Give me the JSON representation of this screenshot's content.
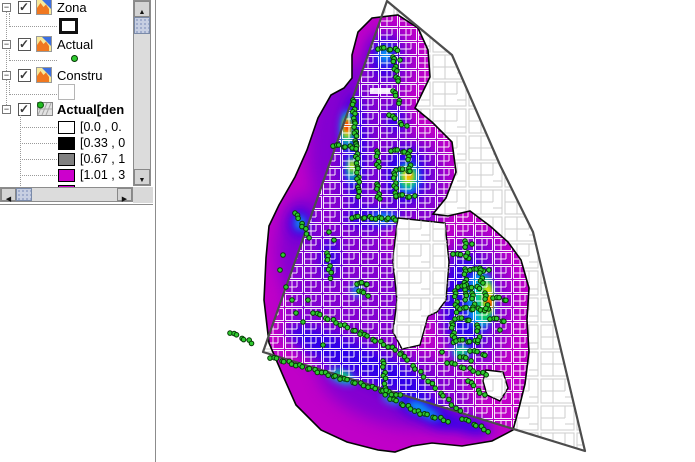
{
  "layer_tree": {
    "items": [
      {
        "label": "Zona",
        "slug": "zona",
        "checked": true,
        "bold": false,
        "icon": "vector-polygon-icon",
        "symbol": {
          "kind": "rect",
          "fill": "#ffffff",
          "border": "#111111",
          "border_px": 3
        }
      },
      {
        "label": "Actual",
        "slug": "actual",
        "checked": true,
        "bold": false,
        "icon": "vector-polygon-icon",
        "symbol": {
          "kind": "dot",
          "fill": "#2fcb2f",
          "border": "#063806"
        }
      },
      {
        "label": "Constru",
        "slug": "constru",
        "checked": true,
        "bold": false,
        "icon": "vector-polygon-icon",
        "symbol": {
          "kind": "rect",
          "fill": "#ffffff",
          "border": "#b5b5b5",
          "border_px": 1
        }
      },
      {
        "label": "Actual[den",
        "slug": "actual-den",
        "checked": true,
        "bold": true,
        "icon": "raster-grid-icon",
        "classes": [
          {
            "color": "#ffffff",
            "label": "[0.0 , 0."
          },
          {
            "color": "#000000",
            "label": "[0.33 , 0"
          },
          {
            "color": "#808080",
            "label": "[0.67 , 1"
          },
          {
            "color": "#cc00cc",
            "label": "[1.01 , 3"
          },
          {
            "color": "#cc00cc",
            "label": ""
          }
        ]
      }
    ]
  },
  "scrollbar": {
    "up": "▲",
    "down": "▼",
    "left": "◀",
    "right": "▶"
  },
  "map": {
    "boundary_color": "#4c4c4c",
    "boundary_path": "M387,1 L452,55 L500,165 L533,232 L585,451 L263,352 Z",
    "parcel_gray": "#cdcdcd",
    "parcel_white": "rgba(255,255,255,0.92)",
    "blob_fill": "#c000c8",
    "blob_outline": "#050505",
    "blob_path": "M372,18 L398,15 L418,28 L428,50 L430,77 L415,108 L432,122 L452,142 L456,172 L446,198 L433,214 L448,216 L470,211 L490,226 L508,242 L521,260 L529,288 L527,320 L529,352 L525,384 L519,408 L513,430 L492,441 L462,446 L432,443 L412,446 L395,452 L378,450 L347,442 L321,430 L296,405 L284,378 L269,343 L264,300 L266,258 L269,226 L279,205 L295,177 L307,150 L318,118 L331,95 L344,88 L352,78 L352,55 L358,32 Z",
    "holes": [
      "M398,218 L445,223 L449,262 L446,300 L437,312 L428,316 L420,345 L402,349 L393,332 L397,300 L393,262 L395,240 Z",
      "M486,370 L503,372 L508,388 L500,401 L487,395 L483,381 Z"
    ],
    "heat_bands": [
      {
        "name": "purple",
        "color": "#8000d2",
        "blur": 8,
        "ellipses": [
          [
            360,
            150,
            52,
            88,
            0
          ],
          [
            348,
            300,
            62,
            78,
            0
          ],
          [
            395,
            385,
            80,
            40,
            15
          ],
          [
            473,
            302,
            38,
            70,
            0
          ],
          [
            388,
            62,
            26,
            34,
            0
          ],
          [
            420,
            185,
            28,
            48,
            0
          ],
          [
            303,
            250,
            26,
            55,
            0
          ],
          [
            390,
            120,
            18,
            26,
            0
          ]
        ]
      },
      {
        "name": "blue",
        "color": "#2a06ea",
        "blur": 6,
        "ellipses": [
          [
            355,
            150,
            12,
            56,
            0
          ],
          [
            405,
            175,
            22,
            30,
            0
          ],
          [
            385,
            58,
            14,
            21,
            0
          ],
          [
            373,
            218,
            30,
            11,
            0
          ],
          [
            358,
            360,
            78,
            16,
            23
          ],
          [
            467,
            303,
            24,
            50,
            0
          ],
          [
            300,
            223,
            10,
            14,
            0
          ],
          [
            420,
            406,
            26,
            12,
            22
          ],
          [
            395,
            120,
            10,
            13,
            0
          ],
          [
            330,
            258,
            9,
            20,
            0
          ],
          [
            385,
            378,
            8,
            14,
            0
          ],
          [
            442,
            420,
            20,
            9,
            15
          ],
          [
            470,
            426,
            22,
            8,
            12
          ]
        ]
      },
      {
        "name": "cyan",
        "color": "#00b6f6",
        "blur": 4,
        "ellipses": [
          [
            347,
            130,
            6,
            20,
            0
          ],
          [
            352,
            170,
            5,
            13,
            0
          ],
          [
            408,
            178,
            11,
            15,
            0
          ],
          [
            385,
            55,
            6,
            9,
            0
          ],
          [
            300,
            223,
            5,
            7,
            0
          ],
          [
            342,
            377,
            14,
            6,
            20
          ],
          [
            418,
            407,
            11,
            5,
            20
          ],
          [
            480,
            300,
            13,
            29,
            0
          ],
          [
            461,
            352,
            9,
            6,
            0
          ],
          [
            384,
            218,
            13,
            5,
            0
          ],
          [
            392,
            399,
            10,
            4,
            20
          ],
          [
            357,
            290,
            5,
            7,
            0
          ],
          [
            430,
            414,
            10,
            4,
            20
          ]
        ]
      },
      {
        "name": "green",
        "color": "#11d24b",
        "blur": 3,
        "ellipses": [
          [
            347,
            129,
            4.5,
            14,
            0
          ],
          [
            408,
            177,
            8,
            11,
            0
          ],
          [
            485,
            300,
            8,
            23,
            0
          ],
          [
            461,
            351,
            6,
            4,
            0
          ],
          [
            352,
            168,
            3.5,
            9,
            0
          ],
          [
            342,
            376,
            8,
            4,
            20
          ]
        ]
      },
      {
        "name": "yellow",
        "color": "#ffe100",
        "blur": 2.5,
        "ellipses": [
          [
            347,
            128,
            3.2,
            10,
            0
          ],
          [
            408,
            176,
            5.5,
            7,
            0
          ],
          [
            488,
            298,
            4.5,
            15,
            0
          ],
          [
            352,
            166,
            2.5,
            6,
            0
          ]
        ]
      },
      {
        "name": "orange",
        "color": "#ff8a00",
        "blur": 2,
        "ellipses": [
          [
            347,
            127,
            2.6,
            7,
            0
          ],
          [
            489,
            303,
            3,
            8,
            0
          ],
          [
            409,
            176,
            2.5,
            3.5,
            0
          ]
        ]
      },
      {
        "name": "red",
        "color": "#ff2000",
        "blur": 1.5,
        "ellipses": [
          [
            347,
            126,
            2.2,
            5.5,
            0
          ],
          [
            489,
            304,
            1.8,
            4,
            0
          ]
        ]
      }
    ],
    "street_label_rect": [
      370,
      88,
      25,
      6
    ],
    "dot_style": {
      "r": 2.3,
      "fill": "#2fcb2f",
      "stroke": "#063806"
    },
    "dot_segments": [
      [
        378,
        48,
        398,
        50,
        7
      ],
      [
        393,
        56,
        396,
        72,
        6
      ],
      [
        396,
        76,
        399,
        82,
        3
      ],
      [
        393,
        90,
        400,
        103,
        5
      ],
      [
        389,
        114,
        406,
        127,
        6
      ],
      [
        353,
        99,
        356,
        143,
        15
      ],
      [
        356,
        143,
        359,
        196,
        17
      ],
      [
        333,
        145,
        356,
        148,
        8
      ],
      [
        295,
        212,
        309,
        237,
        8
      ],
      [
        377,
        150,
        378,
        168,
        6
      ],
      [
        377,
        183,
        379,
        200,
        6
      ],
      [
        391,
        150,
        409,
        152,
        6
      ],
      [
        408,
        153,
        410,
        168,
        5
      ],
      [
        396,
        169,
        411,
        171,
        5
      ],
      [
        394,
        172,
        396,
        196,
        8
      ],
      [
        396,
        195,
        414,
        197,
        6
      ],
      [
        352,
        217,
        396,
        219,
        14
      ],
      [
        357,
        283,
        368,
        284,
        5
      ],
      [
        359,
        290,
        367,
        295,
        4
      ],
      [
        327,
        252,
        331,
        278,
        7
      ],
      [
        270,
        357,
        340,
        378,
        20
      ],
      [
        340,
        378,
        400,
        396,
        16
      ],
      [
        313,
        312,
        360,
        333,
        13
      ],
      [
        360,
        333,
        400,
        352,
        11
      ],
      [
        400,
        353,
        460,
        412,
        16
      ],
      [
        462,
        418,
        488,
        431,
        8
      ],
      [
        383,
        360,
        386,
        395,
        10
      ],
      [
        390,
        398,
        418,
        412,
        9
      ],
      [
        420,
        413,
        448,
        421,
        8
      ],
      [
        447,
        362,
        487,
        375,
        10
      ],
      [
        468,
        380,
        484,
        396,
        6
      ],
      [
        230,
        332,
        252,
        343,
        7
      ],
      [
        453,
        253,
        470,
        258,
        5
      ],
      [
        465,
        268,
        466,
        300,
        10
      ],
      [
        470,
        269,
        488,
        271,
        6
      ],
      [
        480,
        267,
        482,
        284,
        6
      ],
      [
        458,
        286,
        480,
        288,
        7
      ],
      [
        455,
        290,
        457,
        312,
        7
      ],
      [
        472,
        292,
        474,
        307,
        5
      ],
      [
        460,
        308,
        488,
        310,
        9
      ],
      [
        485,
        292,
        487,
        308,
        5
      ],
      [
        455,
        318,
        470,
        320,
        5
      ],
      [
        452,
        322,
        454,
        342,
        7
      ],
      [
        456,
        340,
        478,
        342,
        7
      ],
      [
        477,
        324,
        479,
        340,
        5
      ],
      [
        490,
        318,
        505,
        321,
        5
      ],
      [
        493,
        297,
        507,
        300,
        5
      ],
      [
        470,
        350,
        486,
        355,
        5
      ],
      [
        460,
        356,
        470,
        360,
        4
      ],
      [
        465,
        240,
        467,
        256,
        5
      ]
    ],
    "dot_singles": [
      [
        283,
        255
      ],
      [
        280,
        270
      ],
      [
        286,
        287
      ],
      [
        292,
        300
      ],
      [
        296,
        313
      ],
      [
        303,
        322
      ],
      [
        329,
        232
      ],
      [
        334,
        240
      ],
      [
        400,
        60
      ],
      [
        472,
        244
      ],
      [
        500,
        330
      ],
      [
        442,
        352
      ],
      [
        308,
        300
      ],
      [
        323,
        345
      ]
    ]
  }
}
